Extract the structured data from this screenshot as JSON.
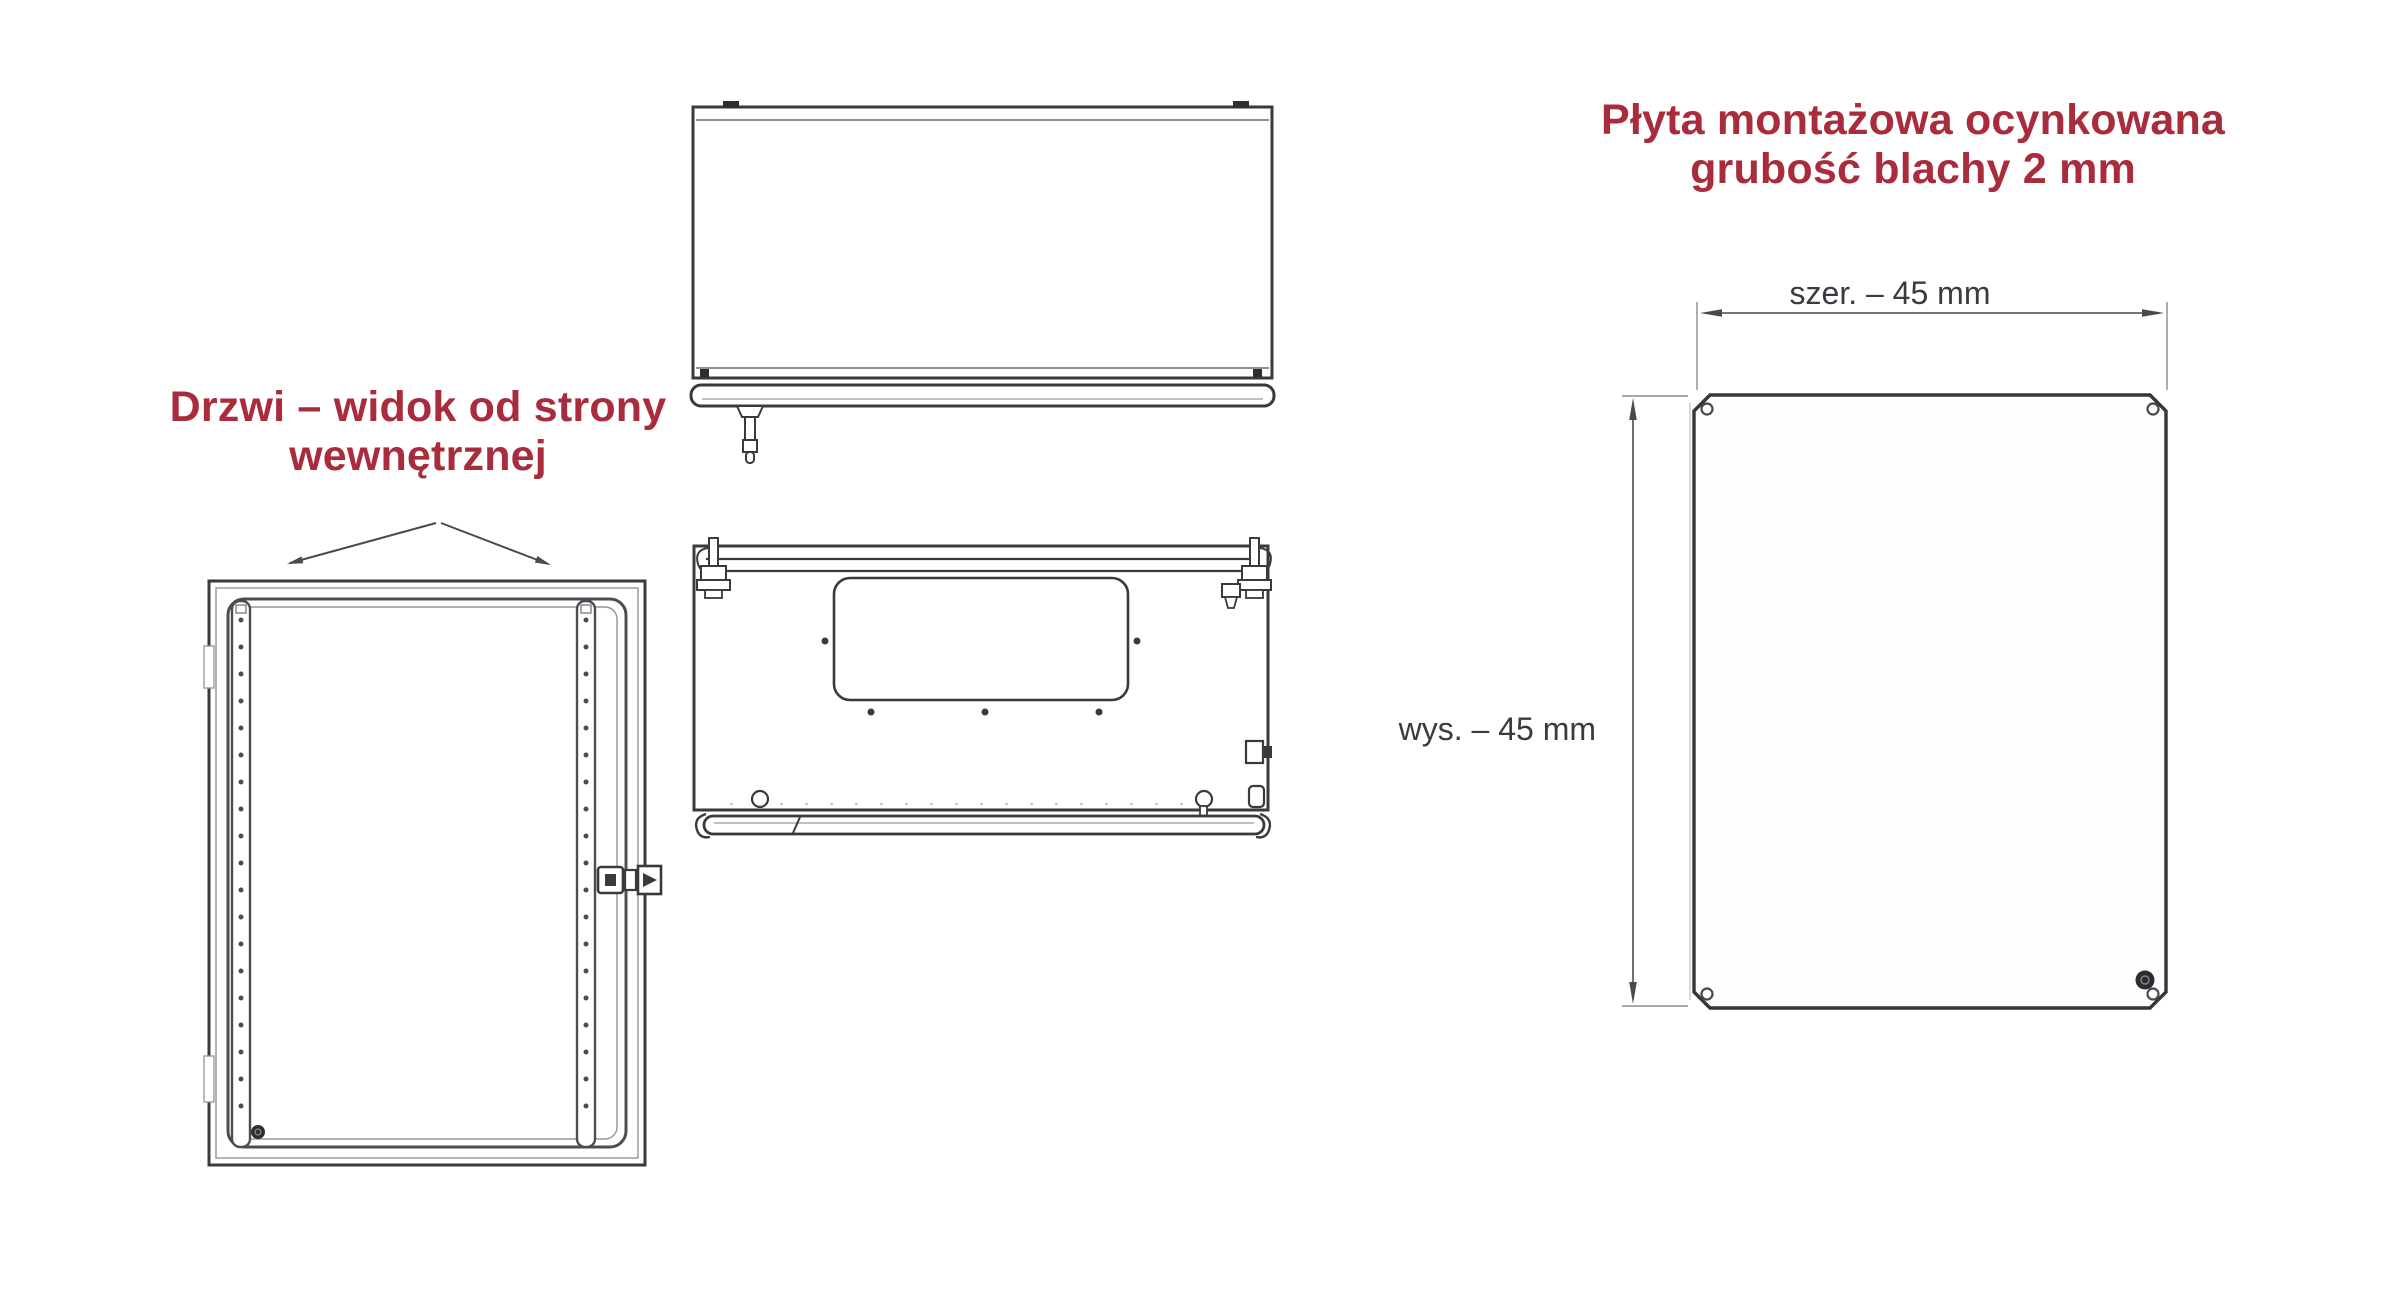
{
  "page": {
    "background": "#ffffff",
    "description_visible_text_language": "pl"
  },
  "door_view": {
    "title": "Drzwi – widok od strony wewnętrznej",
    "title_line1": "Drzwi – widok od strony",
    "title_line2": "wewnętrznej"
  },
  "mounting_plate": {
    "title": "Płyta montażowa ocynkowana grubość blachy 2 mm",
    "title_line1": "Płyta montażowa ocynkowana",
    "title_line2": "grubość blachy 2 mm",
    "width_label": "szer. – 45 mm",
    "height_label": "wys. – 45 mm",
    "width_value_mm": 45,
    "height_value_mm": 45,
    "sheet_thickness_mm": 2
  },
  "colors": {
    "accent_red": "#a82c3c",
    "line_dark": "#3a393d",
    "line_mid": "#6f6e74",
    "line_light": "#96959b",
    "dim_line": "#4a494e",
    "dim_text": "#3b3a40"
  }
}
